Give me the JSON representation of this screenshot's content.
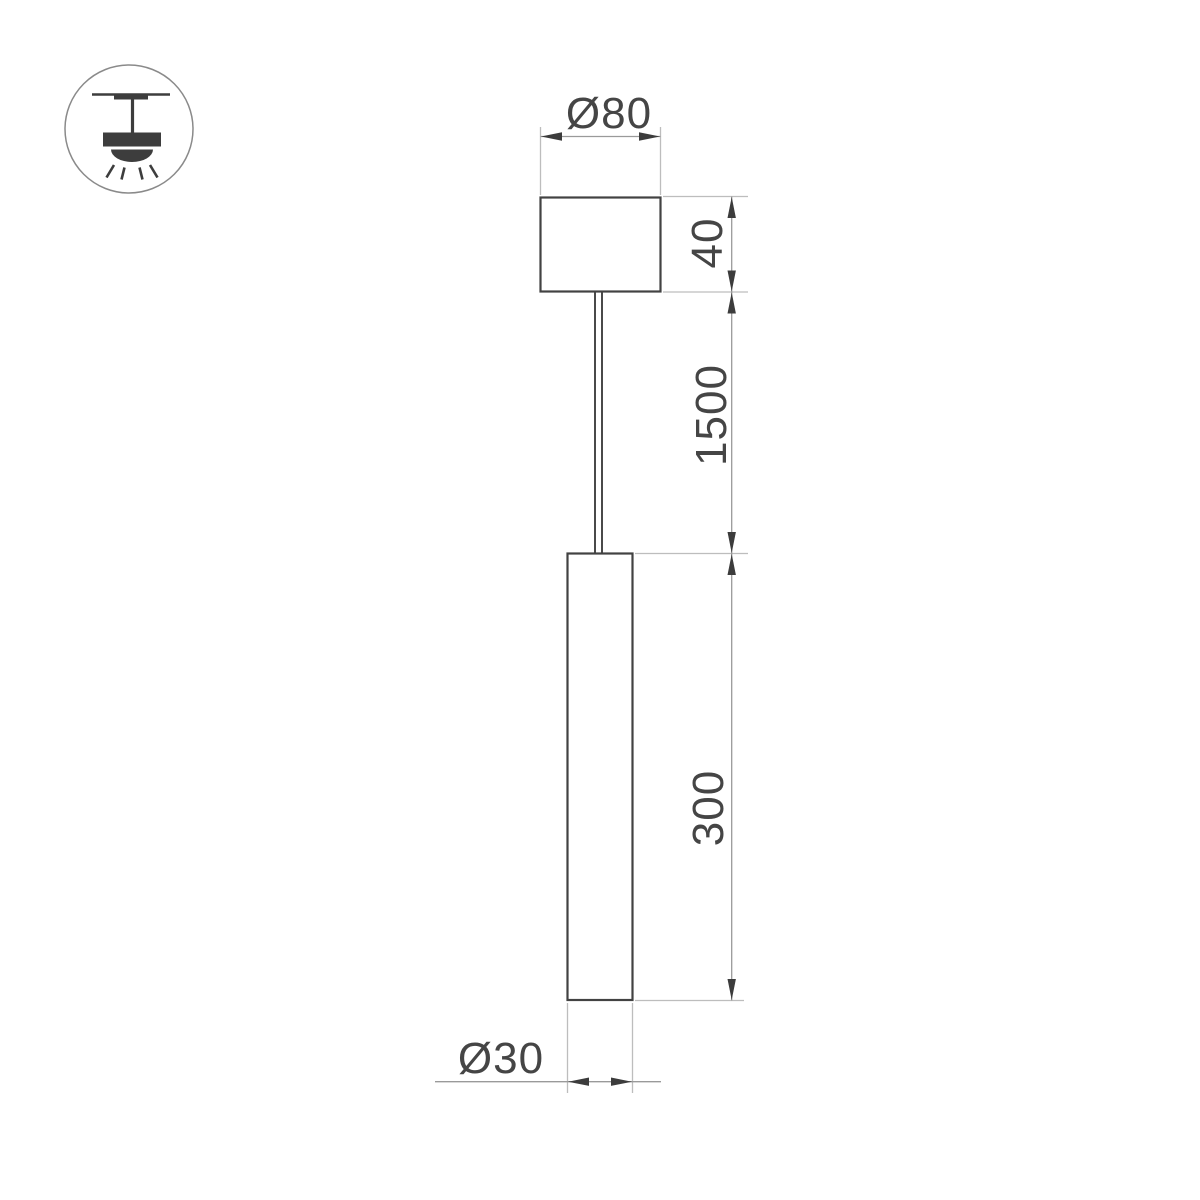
{
  "page": {
    "background": "#ffffff",
    "kind": "pendant luminaire dimension drawing"
  },
  "icon": {
    "name": "ceiling-mount-pendant-light",
    "parts": [
      "ceiling-line",
      "mount-plate",
      "stem",
      "lamp-body",
      "light-dome",
      "light-rays"
    ]
  },
  "dimensions": {
    "canopy_diameter": "Ø80",
    "canopy_height": "40",
    "suspension_length": "1500",
    "tube_length": "300",
    "tube_diameter": "Ø30"
  },
  "colors": {
    "background": "#ffffff",
    "outline": "#424242",
    "cable": "#4a4a4a",
    "dimension_line": "#9a9a9a",
    "extension_line": "#bdbdbd",
    "arrowhead": "#3c3c3c",
    "label_text": "#454545",
    "icon_glyph": "#3d3d3d",
    "icon_circle_stroke": "#8a8a8a"
  }
}
